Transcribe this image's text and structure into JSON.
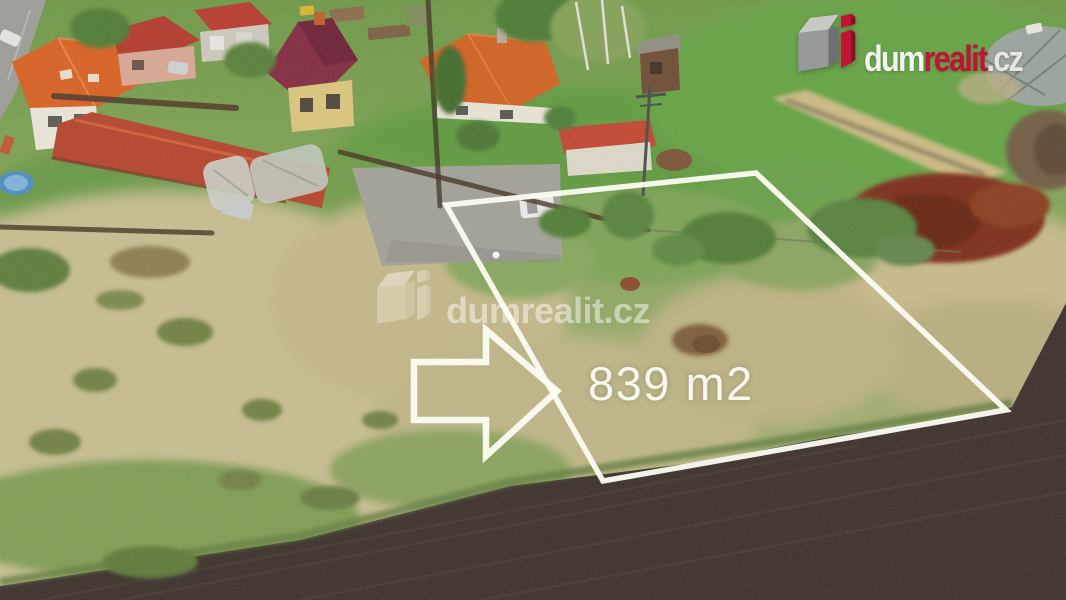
{
  "brand_logo": {
    "text_parts": {
      "dum": "dum",
      "realit": "realit",
      "cz": ".cz"
    },
    "colors": {
      "red": "#c11434",
      "dark_red": "#8a0f26",
      "gray_top": "#c7c9c6",
      "gray_front": "#98999b",
      "gray_side": "#6e7072"
    }
  },
  "watermark": {
    "text_parts": {
      "dum": "dum",
      "realit": "realit",
      "cz": ".cz"
    }
  },
  "plot_overlay": {
    "area_label": "839 m2",
    "outline_color": "#fdfcf2",
    "shape": "quadrilateral-outline",
    "pointer": "right-arrow-outline"
  },
  "scene_colors": {
    "grass_green": "#6f9a47",
    "dry_grass": "#c6bc8f",
    "plowed_field": "#3a2d29",
    "red_bush": "#7d2c15"
  }
}
